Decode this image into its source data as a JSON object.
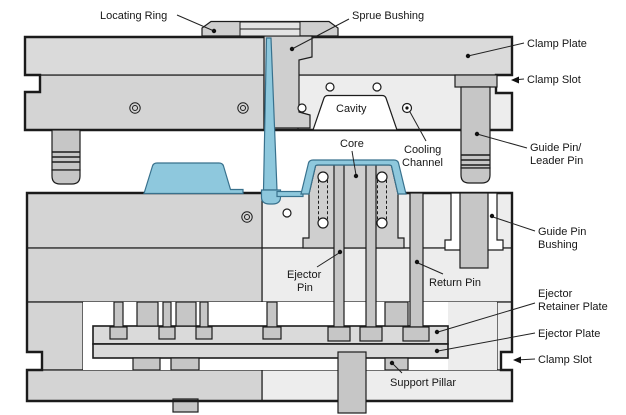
{
  "diagram": {
    "type": "injection-mold-cross-section",
    "labels": {
      "locating_ring": "Locating Ring",
      "sprue_bushing": "Sprue Bushing",
      "clamp_plate": "Clamp Plate",
      "clamp_slot_top": "Clamp Slot",
      "cavity": "Cavity",
      "cooling_channel": {
        "line1": "Cooling",
        "line2": "Channel"
      },
      "core": "Core",
      "guide_pin": {
        "line1": "Guide Pin/",
        "line2": "Leader Pin"
      },
      "guide_pin_bushing": {
        "line1": "Guide Pin",
        "line2": "Bushing"
      },
      "ejector_pin": {
        "line1": "Ejector",
        "line2": "Pin"
      },
      "return_pin": "Return Pin",
      "ejector_retainer_plate": {
        "line1": "Ejector",
        "line2": "Retainer Plate"
      },
      "ejector_plate": "Ejector Plate",
      "clamp_slot_bottom": "Clamp Slot",
      "support_pillar": "Support Pillar"
    },
    "colors": {
      "plate_dark": "#d4d4d4",
      "plate_light": "#ededed",
      "plate_mid": "#dadada",
      "metal": "#c6c6c6",
      "core_metal": "#cfcfcf",
      "ring_metal": "#cfcfcf",
      "part_blue": "#8ec8dd",
      "part_blue_stroke": "#38718d",
      "outline": "#1b1b1b",
      "background": "#ffffff"
    }
  }
}
